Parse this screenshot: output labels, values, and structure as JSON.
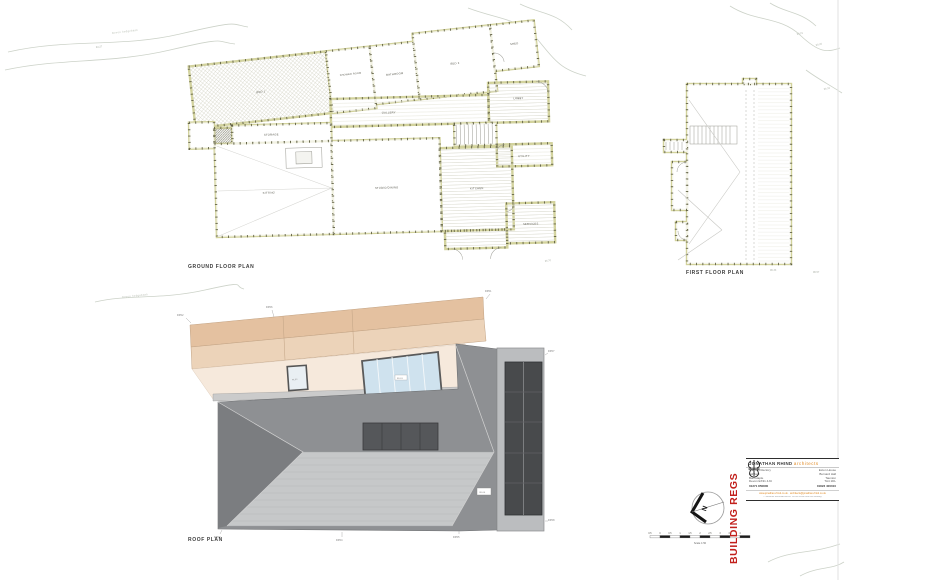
{
  "plans": {
    "ground_floor": {
      "title": "GROUND FLOOR PLAN",
      "rooms": {
        "bed1": "BED 1",
        "shower_room": "SHOWER ROOM",
        "bathroom": "BATHROOM",
        "bed2": "BED 2",
        "shed": "SHED",
        "gallery": "GALLERY",
        "lobby": "LOBBY",
        "storage": "STORAGE",
        "sitting": "SITTING",
        "studio_dining": "STUDIO/DINING",
        "kitchen": "KITCHEN",
        "utility": "UTILITY",
        "services": "SERVICES"
      }
    },
    "first_floor": {
      "title": "FIRST FLOOR PLAN"
    },
    "roof": {
      "title": "ROOF PLAN",
      "rooflight_labels": {
        "rl01": "RL01",
        "rl02": "RL02",
        "rl03": "RL03",
        "rl04": "RL04"
      },
      "edge_labels": {
        "dp01": "DP01",
        "dp02": "DP02",
        "dp03": "DP03",
        "dp04": "DP04",
        "dp05": "DP05",
        "dp06": "DP06",
        "dp07": "DP07",
        "dp08": "DP08"
      }
    }
  },
  "site": {
    "hedgebank": "Devon hedgebank",
    "levels": {
      "a": "94.27",
      "b": "98.21",
      "c": "98.45",
      "d": "96.32",
      "e": "96.33",
      "f": "96.57",
      "g": "95.70"
    }
  },
  "compass": {
    "north": "N"
  },
  "scale_bar": {
    "ticks": [
      "0.5",
      "0",
      "0.5",
      "1",
      "1.5",
      "2",
      "2.5",
      "3",
      "3.5",
      "4"
    ],
    "caption": "Scale 1:50"
  },
  "stamp": {
    "label": "BUILDING REGS"
  },
  "title_block": {
    "firm": "JONATHAN RHIND",
    "firm_suffix": "architects",
    "office_left": {
      "l1": "The Old Rectory",
      "l2": "Ashford",
      "l3": "Barnstaple",
      "l4": "Devon EX31 4JU",
      "l5": "01271 850800"
    },
    "office_right": {
      "l1": "Exton House",
      "l2": "Burnard Hall",
      "l3": "Taunton",
      "l4": "TA4 1DL",
      "l5": "01823 400010"
    },
    "web": "www.jonathan-rhind.co.uk  ·  architects@jonathan-rhind.co.uk",
    "copyright": "© Jonathan Rhind Architects. Do not scale from this drawing."
  }
}
